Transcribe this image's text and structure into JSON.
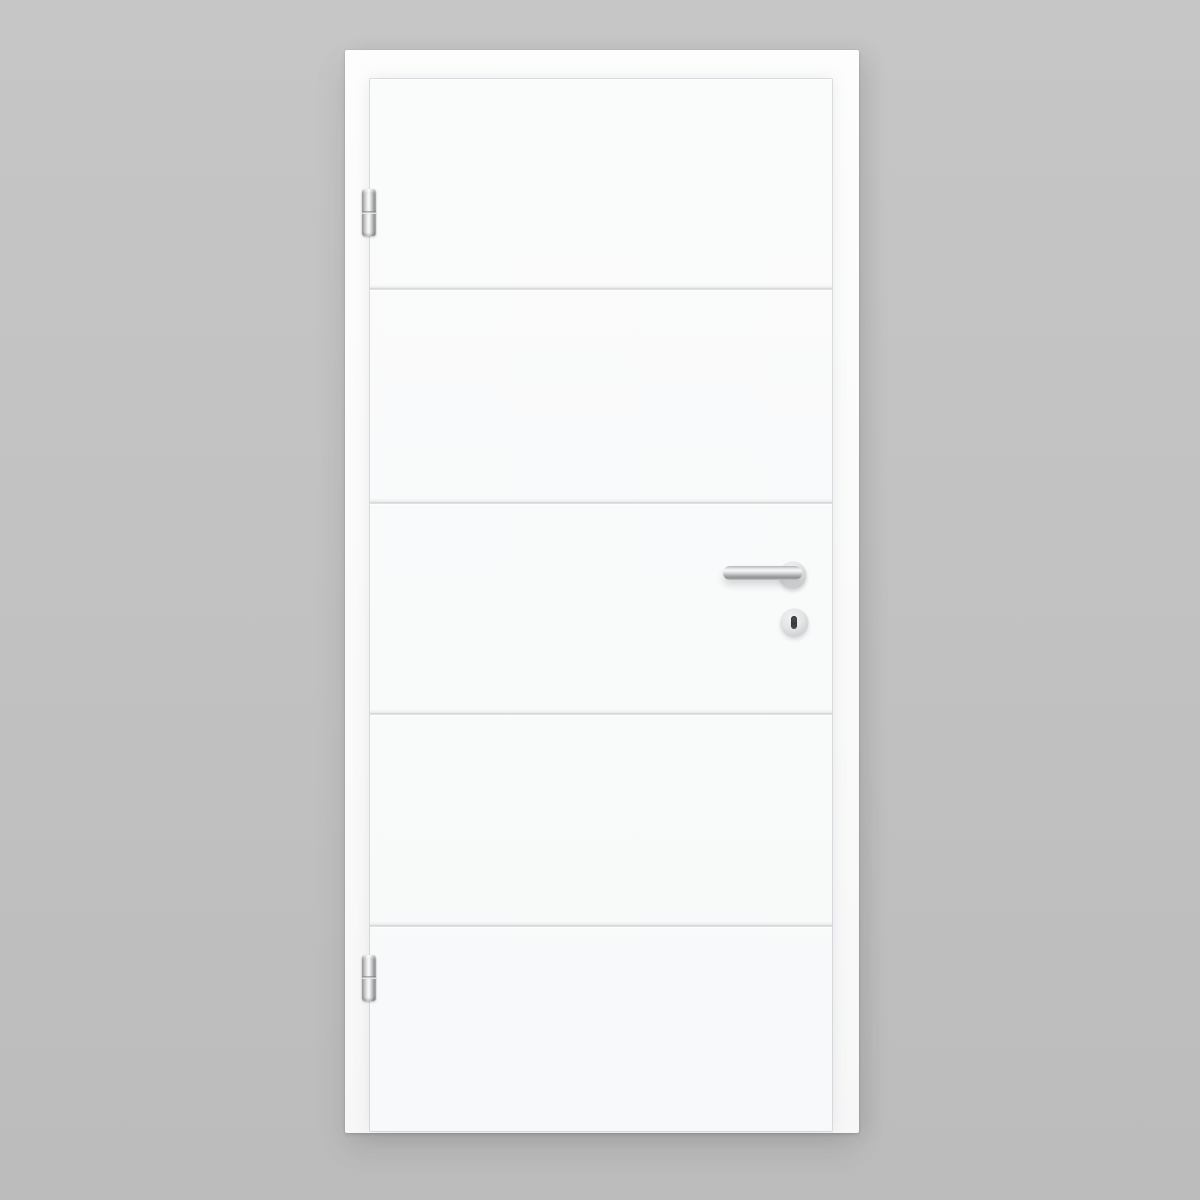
{
  "scene": {
    "type": "product-photo",
    "subject": "White interior door with four horizontal grooves in a white frame on a gray background",
    "door_label": "white lacquered interior door leaf",
    "frame_label": "white door frame casing",
    "background_label": "plain gray studio backdrop"
  },
  "door": {
    "panel_count": 5,
    "groove_count": 4,
    "groove_labels": [
      "groove-1",
      "groove-2",
      "groove-3",
      "groove-4"
    ],
    "hinge_count": 2
  },
  "hardware": {
    "handle_label": "stainless steel lever handle on round rosette",
    "lever_label": "horizontal lever grip",
    "rosette_label": "round handle rosette",
    "escutcheon_label": "round key escutcheon with keyhole",
    "keyhole_label": "keyhole slot",
    "hinge_top_label": "top barrel hinge",
    "hinge_bottom_label": "bottom barrel hinge"
  },
  "colors": {
    "background_gray": "#c1c1c1",
    "frame_white": "#fbfbfb",
    "door_white": "#f9fafa",
    "groove_line": "#c8cace",
    "steel_light": "#f5f5f6",
    "steel_dark": "#8f9194",
    "keyhole_dark": "#39393d"
  }
}
